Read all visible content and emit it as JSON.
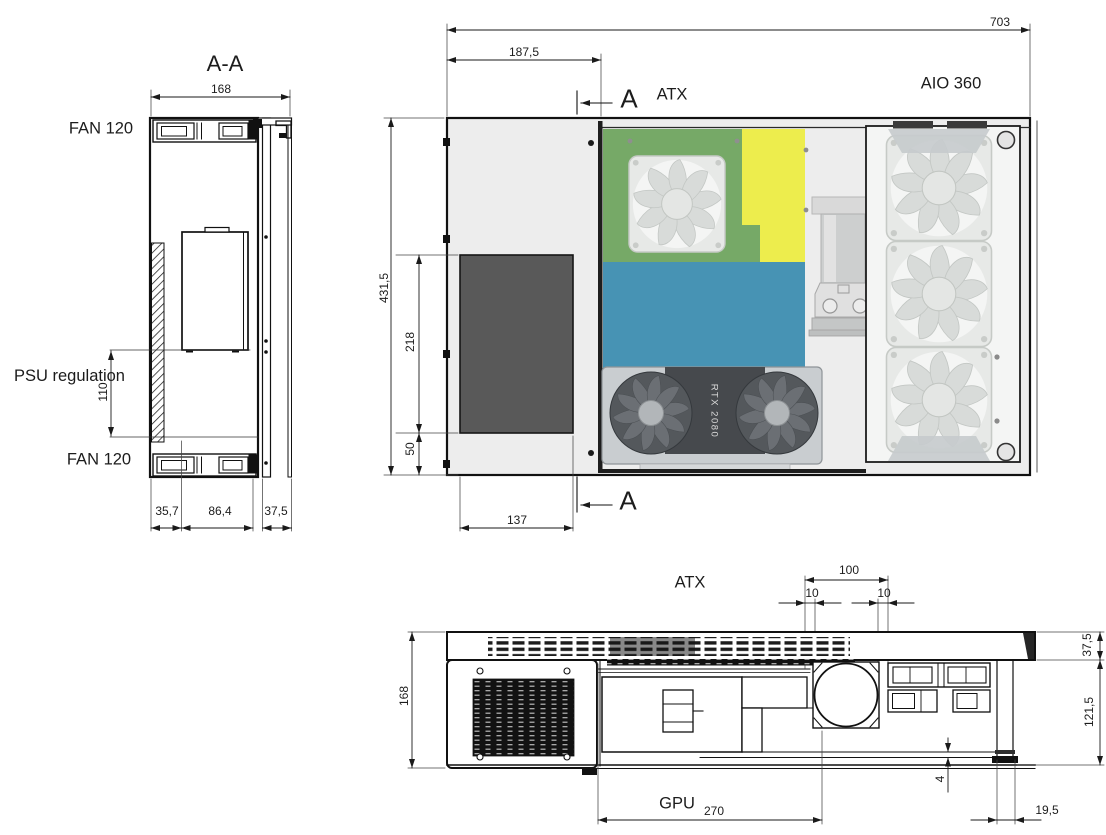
{
  "views": {
    "section": {
      "title": "A-A",
      "fan_top": "FAN 120",
      "fan_bottom": "FAN 120",
      "psu_label": "PSU regulation",
      "dim_width": "168",
      "dim_psu_height": "110",
      "dim_bottom_left": "35,7",
      "dim_bottom_mid": "86,4",
      "dim_bottom_right": "37,5"
    },
    "top": {
      "label_atx": "ATX",
      "label_aio": "AIO 360",
      "marker_top": "A",
      "marker_bottom": "A",
      "gpu_text": "RTX 2080",
      "dim_total_width": "703",
      "dim_left_compartment": "187,5",
      "dim_total_height": "431,5",
      "dim_vent_height": "218",
      "dim_bottom_offset": "50",
      "dim_vent_width": "137"
    },
    "front": {
      "label_atx": "ATX",
      "label_gpu": "GPU",
      "dim_height": "168",
      "dim_pump_zone": "100",
      "dim_margin_left": "10",
      "dim_margin_right": "10",
      "dim_top_band": "37,5",
      "dim_body_height": "121,5",
      "dim_foot_gap": "4",
      "dim_foot_width": "19,5",
      "dim_gpu_length": "270"
    },
    "colors": {
      "motherboard_green": "#76A967",
      "ram_yellow": "#EDED4D",
      "board_blue": "#4793B4",
      "case_gray": "#EDEDED",
      "vent_dark": "#595959",
      "line_black": "#1a1a1a"
    }
  }
}
